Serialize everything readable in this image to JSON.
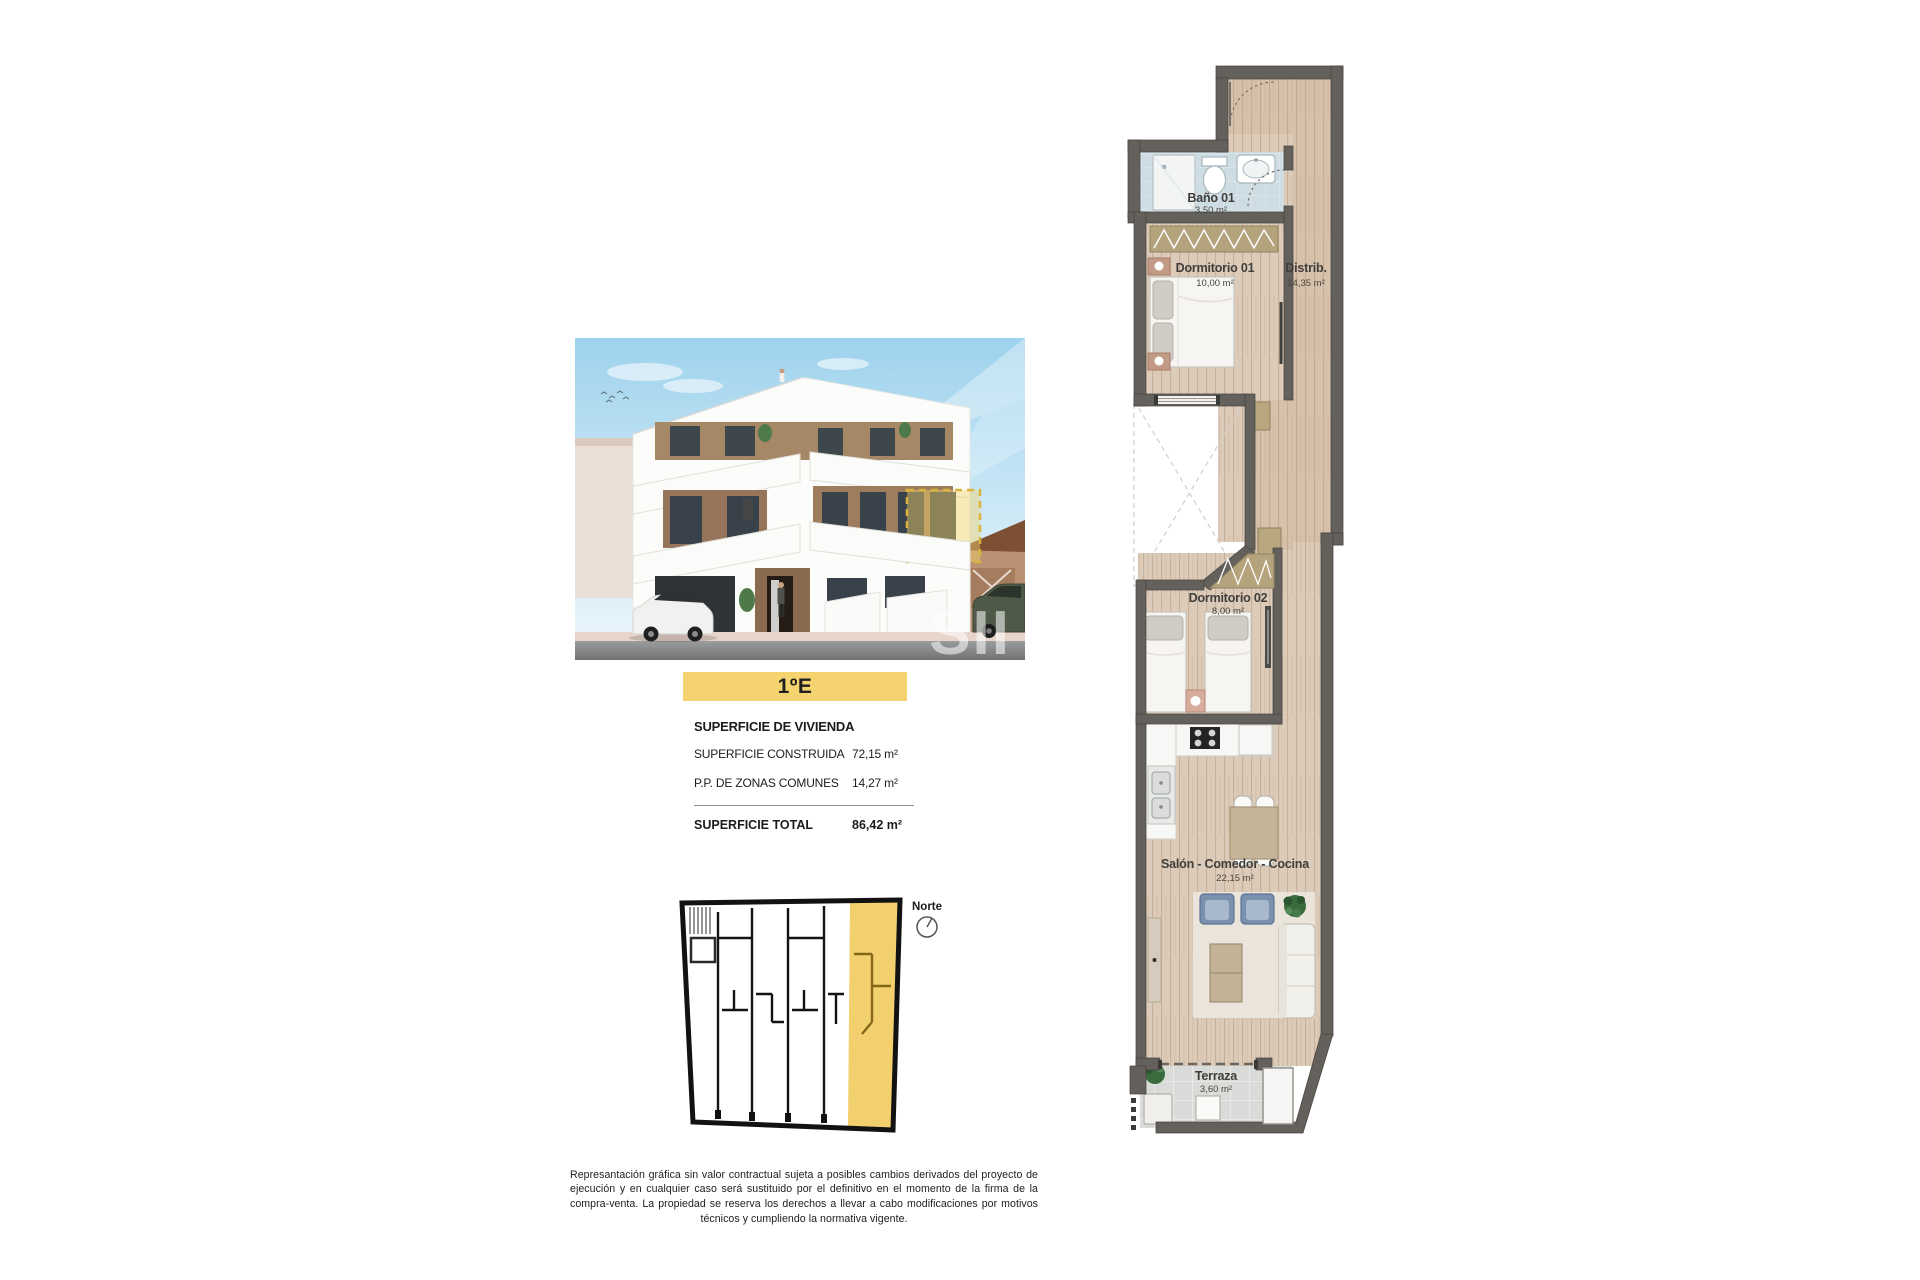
{
  "unit_badge": {
    "label": "1ºE",
    "color": "#F5D36E"
  },
  "surface_card": {
    "heading": "SUPERFICIE DE VIVIENDA",
    "rows": [
      {
        "label": "SUPERFICIE CONSTRUIDA",
        "value": "72,15 m²"
      },
      {
        "label": "P.P. DE ZONAS COMUNES",
        "value": "14,27 m²"
      }
    ],
    "total": {
      "label": "SUPERFICIE TOTAL",
      "value": "86,42 m²"
    }
  },
  "site_plan": {
    "north_label": "Norte",
    "highlight_color": "#F2D06E"
  },
  "render": {
    "watermark": "SII"
  },
  "floor_plan": {
    "wall_color": "#64615C",
    "rooms": [
      {
        "name": "Baño 01",
        "area": "3,50 m²"
      },
      {
        "name": "Dormitorio 01",
        "area": "10,00 m²"
      },
      {
        "name": "Distrib.",
        "area": "14,35 m²"
      },
      {
        "name": "Dormitorio 02",
        "area": "8,00 m²"
      },
      {
        "name": "Salón - Comedor - Cocina",
        "area": "22,15 m²"
      },
      {
        "name": "Terraza",
        "area": "3,60 m²"
      }
    ]
  },
  "disclaimer": {
    "text": "Represantación gráfica sin valor contractual sujeta a posibles cambios derivados del proyecto de ejecución y en cualquier caso será sustituido por el definitivo en el momento de la firma de la compra-venta. La propiedad se reserva los derechos a llevar a cabo modificaciones por motivos técnicos y cumpliendo la normativa vigente."
  }
}
